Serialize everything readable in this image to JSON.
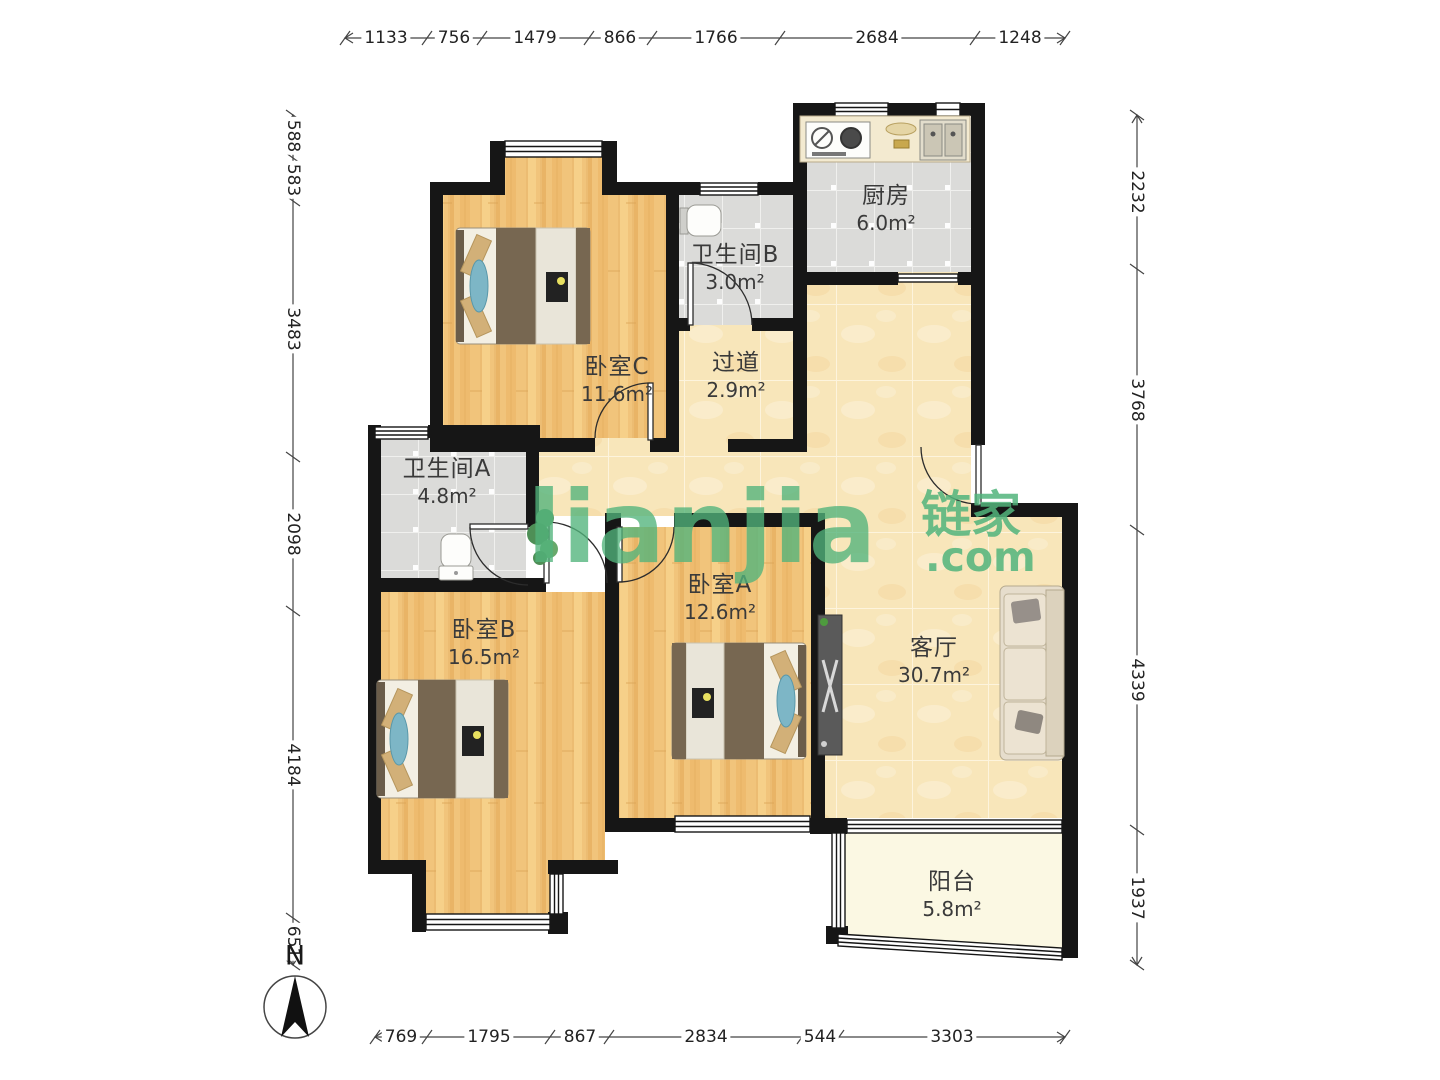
{
  "watermark": {
    "logo_text": "lianjia",
    "brand_cn": "链家",
    "brand_suffix": ".com"
  },
  "compass": {
    "north_label": "N"
  },
  "units": {
    "area": "m²"
  },
  "rooms": {
    "kitchen": {
      "name": "厨房",
      "area": "6.0"
    },
    "bath_b": {
      "name": "卫生间B",
      "area": "3.0"
    },
    "corridor": {
      "name": "过道",
      "area": "2.9"
    },
    "bed_c": {
      "name": "卧室C",
      "area": "11.6"
    },
    "bath_a": {
      "name": "卫生间A",
      "area": "4.8"
    },
    "bed_b": {
      "name": "卧室B",
      "area": "16.5"
    },
    "bed_a": {
      "name": "卧室A",
      "area": "12.6"
    },
    "living": {
      "name": "客厅",
      "area": "30.7"
    },
    "balcony": {
      "name": "阳台",
      "area": "5.8"
    }
  },
  "dimensions_mm": {
    "top": [
      "1133",
      "756",
      "1479",
      "866",
      "1766",
      "2684",
      "1248"
    ],
    "bottom": [
      "769",
      "1795",
      "867",
      "2834",
      "544",
      "3303"
    ],
    "left": [
      "588",
      "583",
      "3483",
      "2098",
      "4184",
      "651"
    ],
    "right": [
      "2232",
      "3768",
      "4339",
      "1937"
    ]
  },
  "colors": {
    "brand_green": "#52b47c",
    "wall": "#161616",
    "wood_floor": "#f1c47b",
    "tile_floor": "#dbdbd9",
    "marble_floor": "#f8e6ba",
    "balcony_floor": "#fbf8e3"
  }
}
